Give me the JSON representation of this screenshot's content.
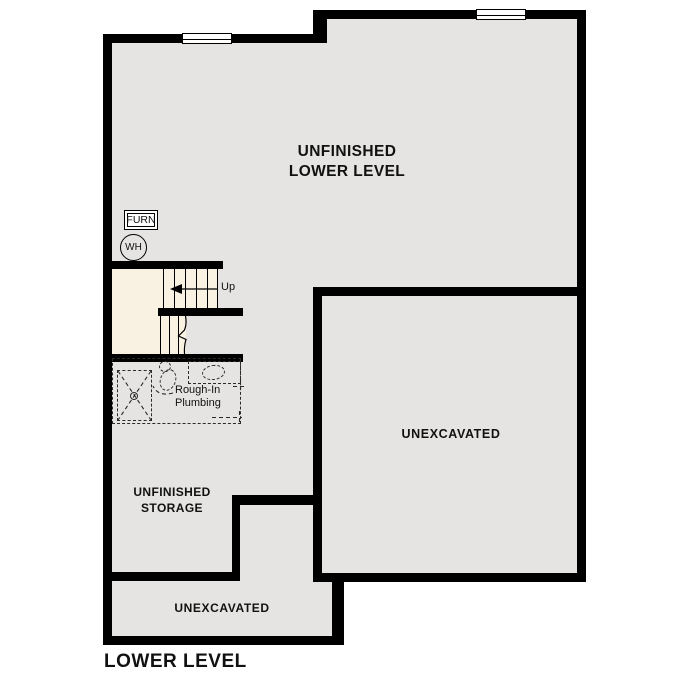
{
  "plan": {
    "title": "LOWER LEVEL",
    "rooms": {
      "lower_level": {
        "line1": "UNFINISHED",
        "line2": "LOWER LEVEL"
      },
      "unexcavated_large": {
        "label": "UNEXCAVATED"
      },
      "unfinished_storage": {
        "line1": "UNFINISHED",
        "line2": "STORAGE"
      },
      "unexcavated_small": {
        "label": "UNEXCAVATED"
      }
    },
    "labels": {
      "furnace": "FURN",
      "water_heater": "WH",
      "stair_direction": "Up",
      "rough_in_line1": "Rough-In",
      "rough_in_line2": "Plumbing"
    },
    "colors": {
      "wall": "#000000",
      "floor": "#e5e4e2",
      "stairwell_fill": "#f9f2e3",
      "window": "#ffffff",
      "text": "#111111",
      "dashed": "#2a2a2a"
    }
  }
}
